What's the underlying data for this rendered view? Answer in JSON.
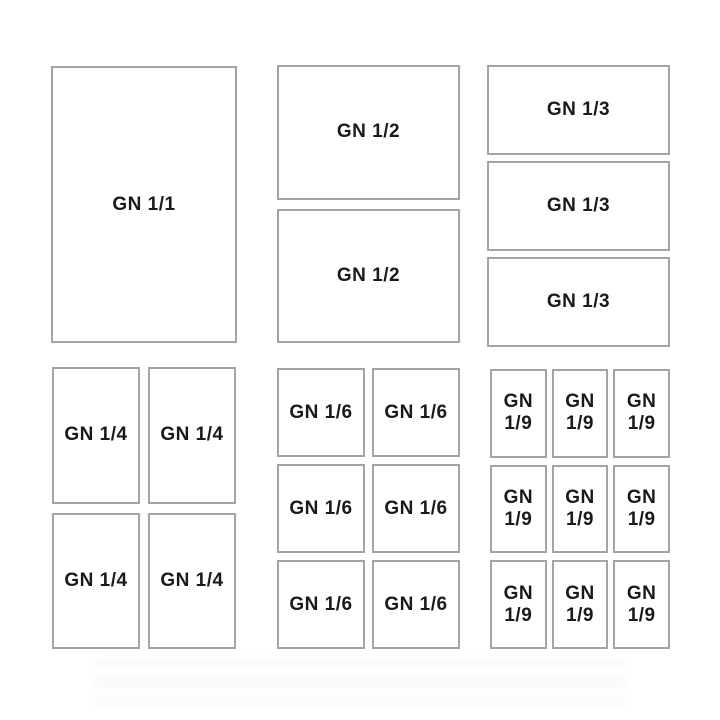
{
  "colors": {
    "background": "#ffffff",
    "pan_border": "#a4a4a4",
    "label_text": "#1a1a1a"
  },
  "panels": {
    "gn11": {
      "cells": [
        "GN 1/1"
      ]
    },
    "gn12": {
      "cells": [
        "GN 1/2",
        "GN 1/2"
      ]
    },
    "gn13": {
      "cells": [
        "GN 1/3",
        "GN 1/3",
        "GN 1/3"
      ]
    },
    "gn14": {
      "cells": [
        "GN 1/4",
        "GN 1/4",
        "GN 1/4",
        "GN 1/4"
      ]
    },
    "gn16": {
      "cells": [
        "GN 1/6",
        "GN 1/6",
        "GN 1/6",
        "GN 1/6",
        "GN 1/6",
        "GN 1/6"
      ]
    },
    "gn19": {
      "cells": [
        "GN\n1/9",
        "GN\n1/9",
        "GN\n1/9",
        "GN\n1/9",
        "GN\n1/9",
        "GN\n1/9",
        "GN\n1/9",
        "GN\n1/9",
        "GN\n1/9"
      ]
    }
  }
}
